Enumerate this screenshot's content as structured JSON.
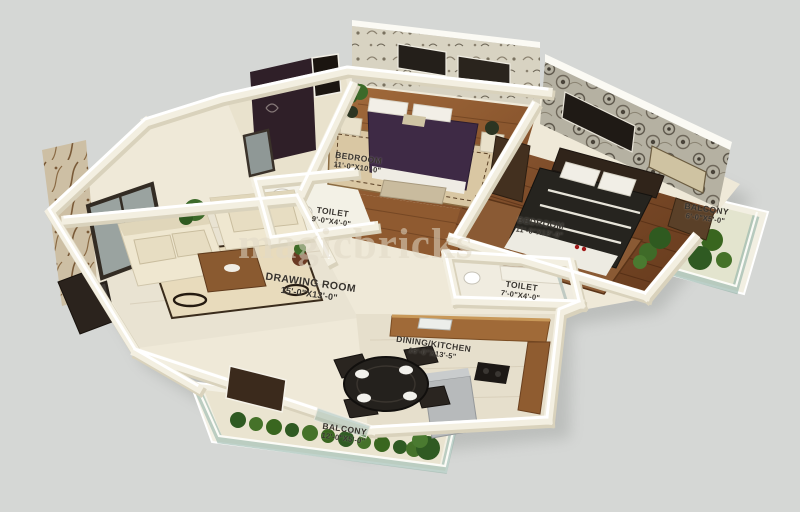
{
  "scene": {
    "type": "3d-isometric-floor-plan-render",
    "watermark": "magicbricks",
    "background_color": "#d5d7d5"
  },
  "rooms": [
    {
      "name": "BEDROOM",
      "dims": "11'-0\"X10'-0\""
    },
    {
      "name": "TOILET",
      "dims": "9'-0\"X4'-0\""
    },
    {
      "name": "BEDROOM",
      "dims": "11'-0\"X13'-0\""
    },
    {
      "name": "DRAWING ROOM",
      "dims": "15'-0\"X13'-0\""
    },
    {
      "name": "TOILET",
      "dims": "7'-0\"X4'-0\""
    },
    {
      "name": "DINING/KITCHEN",
      "dims": "16'-0\"X13'-5\""
    },
    {
      "name": "BALCONY",
      "dims": "12'-0\"X5'-0\""
    },
    {
      "name": "BALCONY",
      "dims": "6'-0\"X5'-0\""
    }
  ],
  "colors": {
    "wall_cream": "#f3efe1",
    "wall_top_white": "#ffffff",
    "wood_floor_light": "#9a6538",
    "wood_floor_dark": "#7c4a26",
    "tile_light": "#e9e3d2",
    "hedge_green": "#3a6526",
    "glass": "#9bb9ac",
    "bed1_duvet": "#3e2a45",
    "bed2_duvet": "#26241f",
    "label_text": "#38342e",
    "wallpaper_light": "#d8d3c2",
    "wallpaper_gray": "#b5b1a2"
  }
}
